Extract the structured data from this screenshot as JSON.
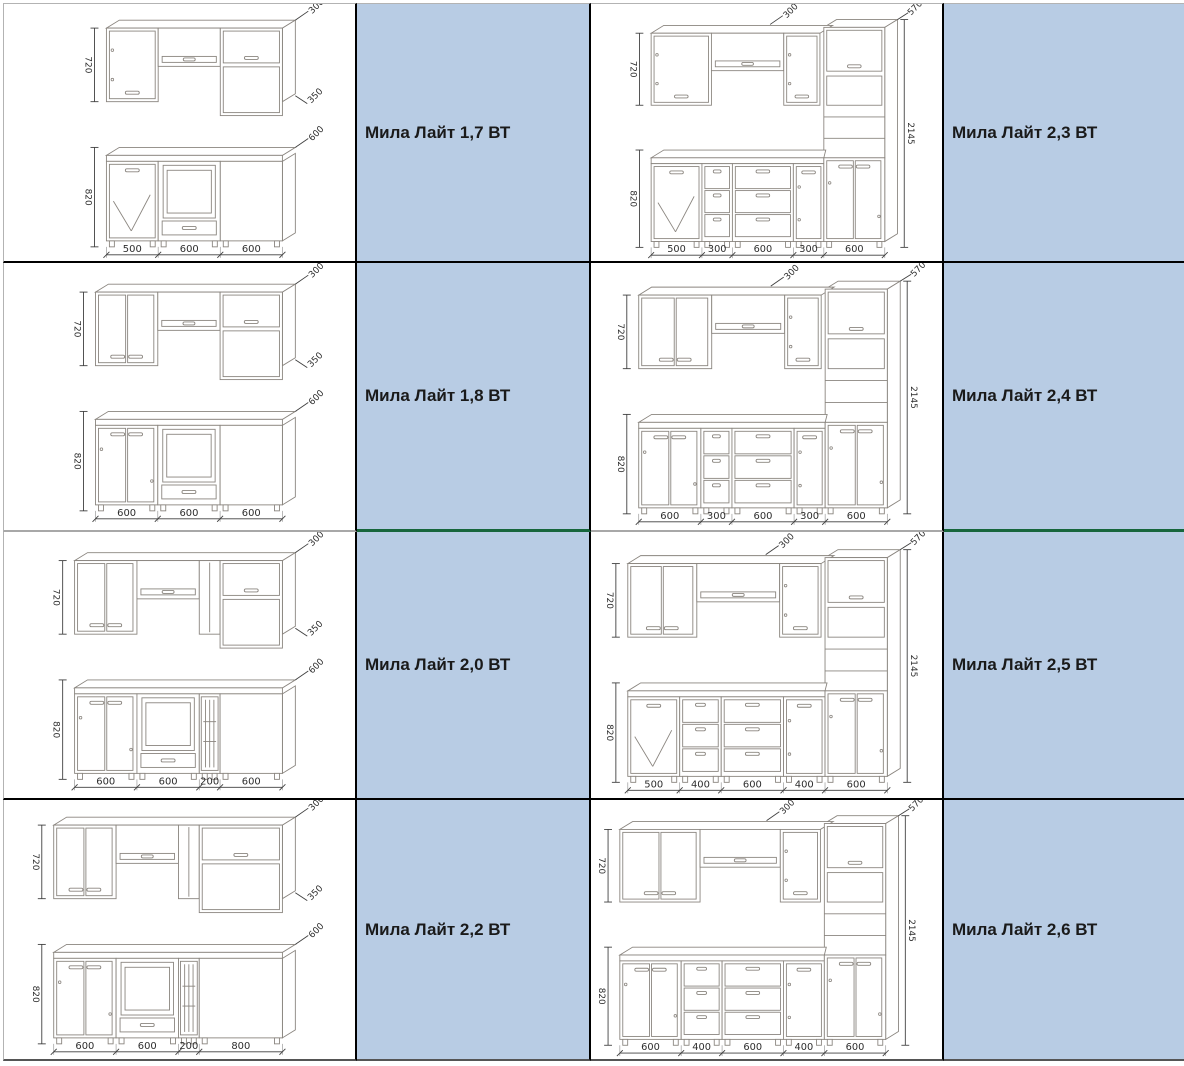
{
  "colors": {
    "label_bg": "#b8cce4",
    "furniture_line": "#8a857f",
    "dim_line": "#3f3f3f",
    "dim_text": "#2d2d2d",
    "grid_black": "#000000",
    "grid_gray": "#a8a8a8",
    "grid_green": "#17663c",
    "outer_border": "#b3b3b3"
  },
  "table": {
    "rows": [
      {
        "left_label": "Мила Лайт 1,7 ВТ",
        "right_label": "Мила Лайт 2,3 ВТ",
        "left_drawing": {
          "type": "straight",
          "upper_height": "720",
          "base_height": "820",
          "depth_upper": "300",
          "depth_shelf": "350",
          "depth_counter": "600",
          "base_widths": [
            "500",
            "600",
            "600"
          ],
          "base_styles": [
            "doorx",
            "oven",
            "drawerdoors"
          ],
          "upper_widths": [
            "500",
            "600",
            "600"
          ],
          "upper_styles": [
            "door1",
            "open",
            "doorshelf"
          ]
        },
        "right_drawing": {
          "type": "tall",
          "upper_height": "720",
          "base_height": "820",
          "depth_upper": "300",
          "depth_tall": "570",
          "total_height": "2145",
          "base_widths": [
            "500",
            "300",
            "600",
            "300",
            "600"
          ],
          "base_styles": [
            "doorx",
            "drawers3",
            "drawers3",
            "door1",
            "doors2"
          ],
          "upper_widths": [
            "500",
            "600",
            "300"
          ],
          "upper_styles": [
            "door1",
            "open",
            "door1"
          ]
        }
      },
      {
        "left_label": "Мила Лайт 1,8 ВТ",
        "right_label": "Мила Лайт 2,4 ВТ",
        "left_drawing": {
          "type": "straight",
          "upper_height": "720",
          "base_height": "820",
          "depth_upper": "300",
          "depth_shelf": "350",
          "depth_counter": "600",
          "base_widths": [
            "600",
            "600",
            "600"
          ],
          "base_styles": [
            "doors2",
            "oven",
            "drawerdoors"
          ],
          "upper_widths": [
            "600",
            "600",
            "600"
          ],
          "upper_styles": [
            "doors2",
            "open",
            "doorshelf"
          ]
        },
        "right_drawing": {
          "type": "tall",
          "upper_height": "720",
          "base_height": "820",
          "depth_upper": "300",
          "depth_tall": "570",
          "total_height": "2145",
          "base_widths": [
            "600",
            "300",
            "600",
            "300",
            "600"
          ],
          "base_styles": [
            "doors2",
            "drawers3",
            "drawers3",
            "door1",
            "doors2"
          ],
          "upper_widths": [
            "600",
            "600",
            "300"
          ],
          "upper_styles": [
            "doors2",
            "open",
            "door1"
          ]
        }
      },
      {
        "left_label": "Мила Лайт 2,0 ВТ",
        "right_label": "Мила Лайт 2,5 ВТ",
        "left_drawing": {
          "type": "straight",
          "upper_height": "720",
          "base_height": "820",
          "depth_upper": "300",
          "depth_shelf": "350",
          "depth_counter": "600",
          "base_widths": [
            "600",
            "600",
            "200",
            "600"
          ],
          "base_styles": [
            "doors2",
            "oven",
            "cart",
            "drawerdoors"
          ],
          "upper_widths": [
            "600",
            "600",
            "200",
            "600"
          ],
          "upper_styles": [
            "doors2",
            "open",
            "narrow",
            "doorshelf"
          ]
        },
        "right_drawing": {
          "type": "tall",
          "upper_height": "720",
          "base_height": "820",
          "depth_upper": "300",
          "depth_tall": "570",
          "total_height": "2145",
          "base_widths": [
            "500",
            "400",
            "600",
            "400",
            "600"
          ],
          "base_styles": [
            "doorx",
            "drawers3",
            "drawers3",
            "door1",
            "doors2"
          ],
          "upper_widths": [
            "500",
            "600",
            "300"
          ],
          "upper_styles": [
            "doors2",
            "open",
            "door1"
          ]
        }
      },
      {
        "left_label": "Мила Лайт 2,2 ВТ",
        "right_label": "Мила Лайт 2,6 ВТ",
        "left_drawing": {
          "type": "straight",
          "upper_height": "720",
          "base_height": "820",
          "depth_upper": "300",
          "depth_shelf": "350",
          "depth_counter": "600",
          "base_widths": [
            "600",
            "600",
            "200",
            "800"
          ],
          "base_styles": [
            "doors2",
            "oven",
            "cart",
            "drawerdoors"
          ],
          "upper_widths": [
            "600",
            "600",
            "200",
            "800"
          ],
          "upper_styles": [
            "doors2",
            "open",
            "narrow",
            "doorshelf"
          ]
        },
        "right_drawing": {
          "type": "tall",
          "upper_height": "720",
          "base_height": "820",
          "depth_upper": "300",
          "depth_tall": "570",
          "total_height": "2145",
          "base_widths": [
            "600",
            "400",
            "600",
            "400",
            "600"
          ],
          "base_styles": [
            "doors2",
            "drawers3",
            "drawers3",
            "door1",
            "doors2"
          ],
          "upper_widths": [
            "600",
            "600",
            "300"
          ],
          "upper_styles": [
            "doors2",
            "open",
            "door1"
          ]
        }
      }
    ]
  }
}
